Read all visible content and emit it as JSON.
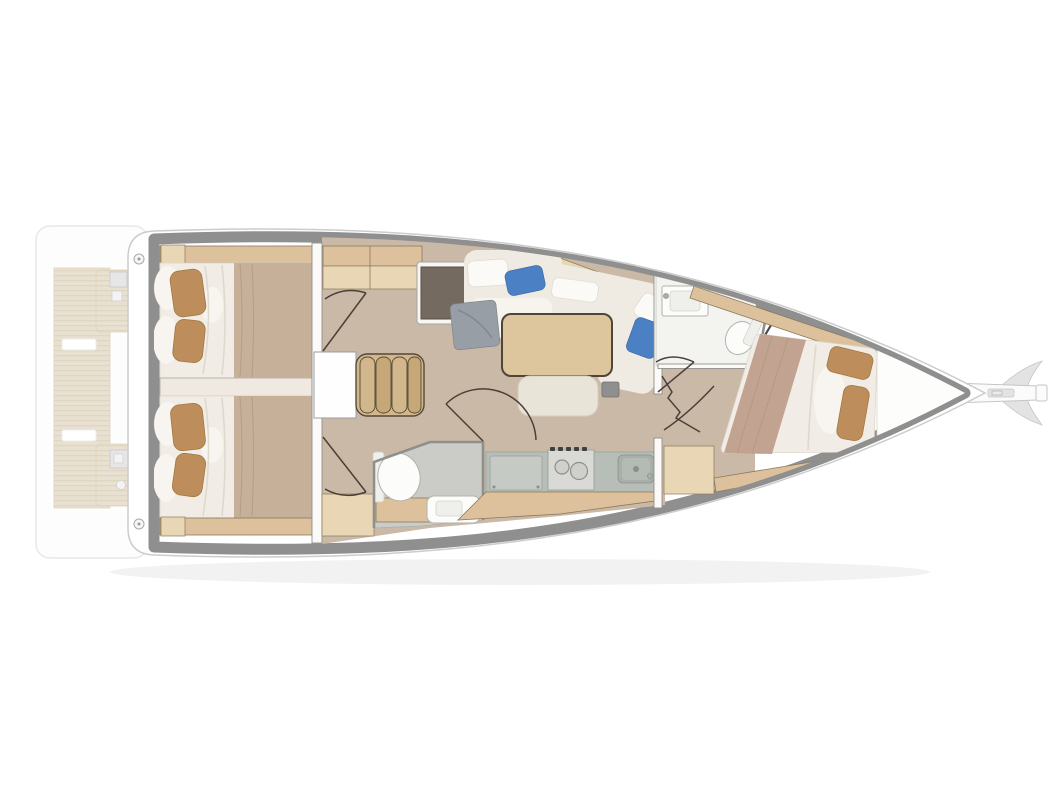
{
  "figure": {
    "type": "floor-plan",
    "subject": "sailboat-interior-top-view",
    "orientation": "bow-right",
    "cabins": 3,
    "heads": 2
  },
  "rooms": [
    {
      "name": "swim-platform",
      "features": [
        "teak-deck",
        "transom-lockers"
      ]
    },
    {
      "name": "aft-cabin-port",
      "features": [
        "double-berth",
        "two-pillows",
        "beige-blanket",
        "locker-shelf"
      ]
    },
    {
      "name": "aft-cabin-starboard",
      "features": [
        "double-berth",
        "two-pillows",
        "beige-blanket",
        "locker-shelf"
      ]
    },
    {
      "name": "companionway",
      "features": [
        "four-steps",
        "landing",
        "cabin-doors"
      ]
    },
    {
      "name": "salon",
      "features": [
        "chart-table",
        "l-shaped-sofa",
        "dining-table",
        "ottoman",
        "blue-cushions",
        "gray-throw"
      ]
    },
    {
      "name": "galley",
      "features": [
        "refrigerator-panel",
        "stove",
        "sink",
        "lockers"
      ]
    },
    {
      "name": "aft-head",
      "features": [
        "toilet",
        "vanity-sink"
      ]
    },
    {
      "name": "forward-head",
      "features": [
        "sink",
        "toilet",
        "shower-screen"
      ]
    },
    {
      "name": "forward-cabin",
      "features": [
        "angled-double-berth",
        "two-pillows",
        "dresser",
        "hull-shelves"
      ]
    },
    {
      "name": "bow",
      "features": [
        "sail-locker",
        "bowsprit",
        "anchor-roller"
      ]
    }
  ],
  "colors": {
    "page_bg": "#ffffff",
    "hull_white": "#ffffff",
    "hull_stroke": "#cccccc",
    "deck_band": "#8f8f8f",
    "shadow": "#000000",
    "floor_taupe": "#cbb9a7",
    "wood_tan": "#dcc19c",
    "wood_tan_light": "#e8d6b5",
    "wood_stroke": "#8a7a5f",
    "bed_white": "#f1ede6",
    "bed_ruffle": "#f8f5f0",
    "fold_line": "#ddd6ca",
    "blanket_beige": "#c7b09a",
    "blanket_mauve": "#c2a391",
    "pillow_tan": "#bd8e5c",
    "pillow_stroke": "#a2783f",
    "pillow_blue": "#4b80c4",
    "sofa_cream": "#efebe2",
    "seat_white": "#f7f4ee",
    "throw_gray": "#979ea6",
    "table_wood": "#ddc59e",
    "table_stroke": "#4f463a",
    "ottoman": "#e9e4d8",
    "desk_brown": "#756a60",
    "desk_stroke": "#57504a",
    "counter_gray": "#b7bdb7",
    "panel_gray": "#c6cac4",
    "panel_stroke": "#9aa19a",
    "steel_light": "#d9dad6",
    "basin_gray": "#a8aea8",
    "basin_inner": "#b4bab4",
    "knob_dark": "#3f3f3f",
    "fixture_white": "#fcfcfa",
    "fixture_stroke": "#b2b2ad",
    "head_floor_gray": "#cbccc8",
    "head_floor_white": "#f3f3f0",
    "wall_white": "#fbfaf8",
    "wall_stroke": "#8f8f8b",
    "door_line": "#4a4038",
    "divider": "#efe9e1",
    "divider_stroke": "#b9b2a8",
    "step_tan": "#d2b68c",
    "step_tan_dark": "#c6a878",
    "step_stroke": "#55493a",
    "teak": "#d9cdb2",
    "teak_line": "#c6b794",
    "platform_white": "#fdfdfd",
    "platform_stroke": "#d9d9d9",
    "white_zone": "#fdfdfb",
    "box_gray": "#8f8f8f",
    "sprit_white": "#fbfbfb",
    "sprit_gray": "#e3e3e3",
    "sprit_stroke": "#c6c6c6"
  }
}
